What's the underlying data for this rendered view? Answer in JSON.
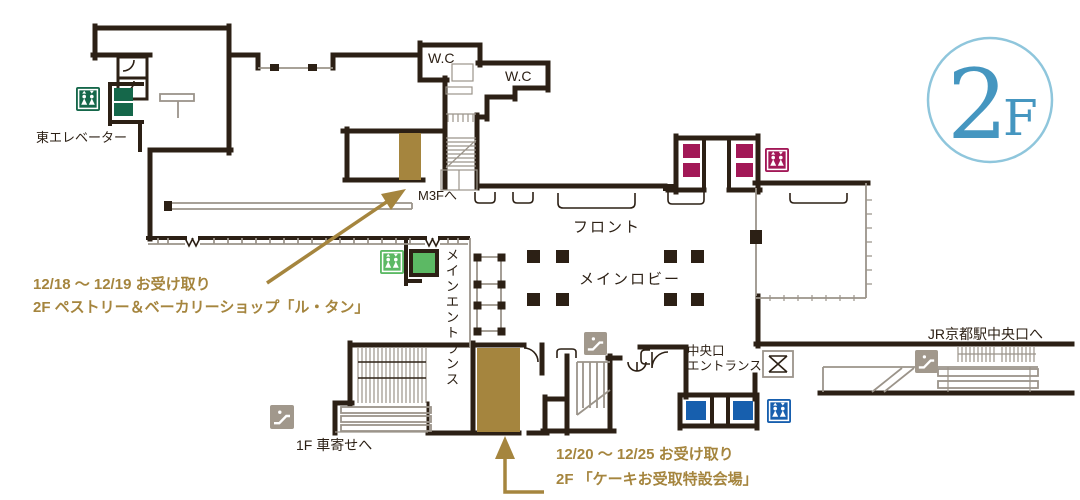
{
  "floor_badge": {
    "number": "2",
    "suffix": "F"
  },
  "labels": {
    "east_elevator": "東エレベーター",
    "wc_left": "W.C",
    "wc_right": "W.C",
    "m3f": "M3Fへ",
    "front_desk": "フロント",
    "main_lobby": "メインロビー",
    "main_entrance": "メインエントランス",
    "central_entrance_l1": "中央口",
    "central_entrance_l2": "エントランス",
    "jr_kyoto_central": "JR京都駅中央口へ",
    "to_1f_porch": "1F 車寄せへ"
  },
  "annotations": {
    "pastry_pickup": {
      "line1": "12/18 ～ 12/19  お受け取り",
      "line2": "2F ペストリー＆ベーカリーショップ「ル・タン」"
    },
    "cake_pickup": {
      "line1": "12/20 ～ 12/25  お受け取り",
      "line2": "2F 「ケーキお受取特設会場」"
    }
  },
  "colors": {
    "wall": "#2c2015",
    "thin_line": "#9b948a",
    "gold": "#a5853e",
    "dark_green": "#15674a",
    "light_green": "#5cb964",
    "magenta": "#a21857",
    "blue": "#175fae",
    "icon_gray": "#a1988c",
    "light_fill": "#e7e3df",
    "badge_text": "#4596c0",
    "badge_ring": "#8fc6dc"
  }
}
